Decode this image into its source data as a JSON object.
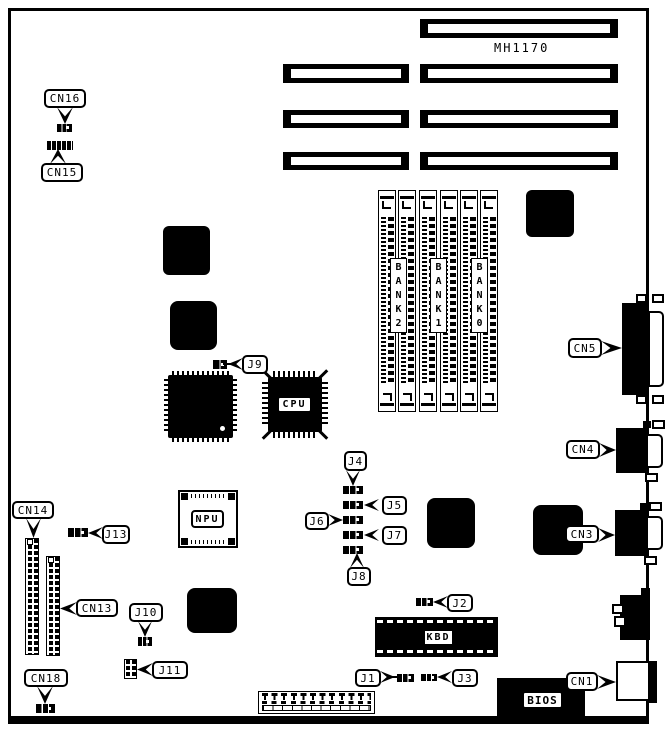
{
  "board": {
    "model_text": "MH1170"
  },
  "labels": {
    "cn1": "CN1",
    "cn3": "CN3",
    "cn4": "CN4",
    "cn5": "CN5",
    "cn13": "CN13",
    "cn14": "CN14",
    "cn15": "CN15",
    "cn16": "CN16",
    "cn18": "CN18",
    "j1": "J1",
    "j2": "J2",
    "j3": "J3",
    "j4": "J4",
    "j5": "J5",
    "j6": "J6",
    "j7": "J7",
    "j8": "J8",
    "j9": "J9",
    "j10": "J10",
    "j11": "J11",
    "j13": "J13",
    "cpu": "CPU",
    "npu": "NPU",
    "kbd": "KBD",
    "bios": "BIOS",
    "bank0": "BANK0",
    "bank1": "BANK1",
    "bank2": "BANK2"
  }
}
